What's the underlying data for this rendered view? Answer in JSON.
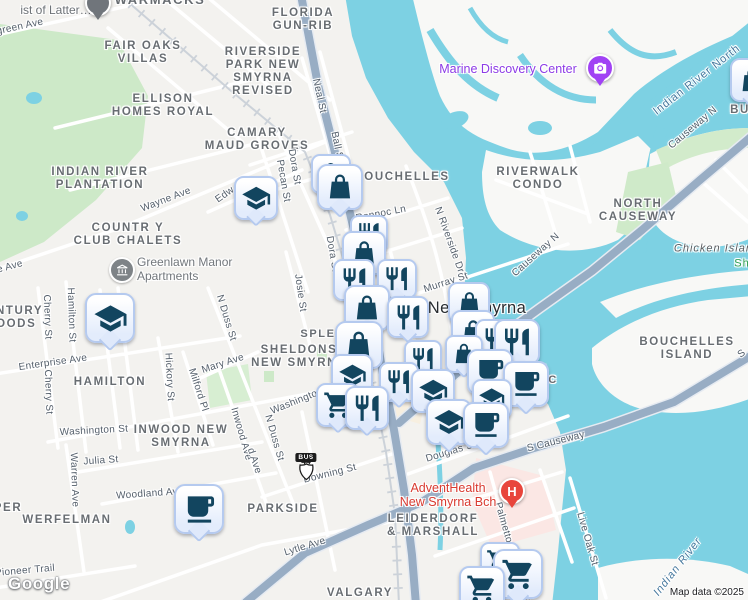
{
  "attribution": {
    "logo": "Google",
    "map_data": "Map data ©2025"
  },
  "shield": {
    "banner": "BUS",
    "route": "44"
  },
  "colors": {
    "water": "#7dd1e3",
    "park": "#cde9c8",
    "major_road": "#98adc4",
    "marker_border": "#b5caef",
    "marker_glyph": "#12455f",
    "hospital_red": "#e8453c",
    "poi_purple": "#8d3be6",
    "adventhealth_red": "#d93a30",
    "water_label": "#47799e"
  },
  "area_labels": [
    {
      "lines": [
        "WARMACKS"
      ],
      "x": 160,
      "y": -7,
      "s": 13
    },
    {
      "lines": [
        "FLORIDA",
        "GUN-RIB"
      ],
      "x": 303,
      "y": 7,
      "s": 11.5
    },
    {
      "lines": [
        "FAIR OAKS",
        "VILLAS"
      ],
      "x": 143,
      "y": 40,
      "s": 11.5
    },
    {
      "lines": [
        "RIVERSIDE",
        "PARK NEW",
        "SMYRNA",
        "REVISED"
      ],
      "x": 263,
      "y": 46,
      "s": 11.5
    },
    {
      "lines": [
        "ELLISON",
        "HOMES ROYAL"
      ],
      "x": 163,
      "y": 93,
      "s": 11.5
    },
    {
      "lines": [
        "CAMARY",
        "MAUD GROVES"
      ],
      "x": 257,
      "y": 127,
      "s": 11.5
    },
    {
      "lines": [
        "INDIAN RIVER",
        "PLANTATION"
      ],
      "x": 100,
      "y": 166,
      "s": 11.5
    },
    {
      "lines": [
        "COUNTR Y",
        "CLUB CHALETS"
      ],
      "x": 128,
      "y": 222,
      "s": 11.5
    },
    {
      "lines": [
        "BOUCHELLES"
      ],
      "x": 402,
      "y": 171,
      "s": 11.5
    },
    {
      "lines": [
        "RIVERWALK",
        "CONDO"
      ],
      "x": 538,
      "y": 166,
      "s": 11.5
    },
    {
      "lines": [
        "NORTH",
        "CAUSEWAY"
      ],
      "x": 638,
      "y": 198,
      "s": 11.5
    },
    {
      "lines": [
        "CENTURY",
        "WOODS"
      ],
      "x": 10,
      "y": 305,
      "s": 11.5
    },
    {
      "lines": [
        "HAMILTON"
      ],
      "x": 110,
      "y": 376,
      "s": 11.5
    },
    {
      "lines": [
        "SPLE"
      ],
      "x": 318,
      "y": 328,
      "s": 11
    },
    {
      "lines": [
        "SHELDONS",
        "NEW SMYRNA"
      ],
      "x": 299,
      "y": 344,
      "s": 11.5
    },
    {
      "lines": [
        "INWOOD NEW",
        "SMYRNA"
      ],
      "x": 181,
      "y": 424,
      "s": 11.5
    },
    {
      "lines": [
        "WERFELMAN"
      ],
      "x": 67,
      "y": 514,
      "s": 11.5
    },
    {
      "lines": [
        "PER"
      ],
      "x": 8,
      "y": 502,
      "s": 11.5
    },
    {
      "lines": [
        "PARKSIDE"
      ],
      "x": 283,
      "y": 503,
      "s": 11.5
    },
    {
      "lines": [
        "LEIDERDORF",
        "& MARSHALL"
      ],
      "x": 433,
      "y": 513,
      "s": 11.5
    },
    {
      "lines": [
        "VALGARY"
      ],
      "x": 360,
      "y": 587,
      "s": 11.5
    },
    {
      "lines": [
        "BOUCHELLES",
        "ISLAND"
      ],
      "x": 687,
      "y": 336,
      "s": 11.5
    },
    {
      "lines": [
        "BU"
      ],
      "x": 740,
      "y": 104,
      "s": 11.5
    },
    {
      "lines": [
        "A"
      ],
      "x": 545,
      "y": 363,
      "s": 11
    },
    {
      "lines": [
        "RIC"
      ],
      "x": 546,
      "y": 374,
      "s": 11
    },
    {
      "lines": [
        "New Smyrna"
      ],
      "x": 477,
      "y": 299,
      "s": 16.5,
      "ls": 0.4,
      "c": "#272b2f",
      "w": 500
    }
  ],
  "street_labels": [
    {
      "t": "green Ave",
      "x": 20,
      "y": 27,
      "r": -12
    },
    {
      "t": "Wayne Ave",
      "x": 166,
      "y": 200,
      "r": -21
    },
    {
      "t": "e Ave",
      "x": 10,
      "y": 267,
      "r": -15
    },
    {
      "t": "Edw",
      "x": 225,
      "y": 195,
      "r": -35
    },
    {
      "t": "Neal St",
      "x": 319,
      "y": 96,
      "r": 78
    },
    {
      "t": "Ball St",
      "x": 337,
      "y": 147,
      "r": 78
    },
    {
      "t": "Dora St",
      "x": 294,
      "y": 167,
      "r": 80
    },
    {
      "t": "Dora St",
      "x": 332,
      "y": 254,
      "r": 80
    },
    {
      "t": "Pecan St",
      "x": 283,
      "y": 181,
      "r": 80
    },
    {
      "t": "Josie St",
      "x": 300,
      "y": 293,
      "r": 82
    },
    {
      "t": "Ronnoc Ln",
      "x": 381,
      "y": 214,
      "r": -11
    },
    {
      "t": "N Riverside Dr",
      "x": 449,
      "y": 240,
      "r": 70
    },
    {
      "t": "Murray St",
      "x": 446,
      "y": 283,
      "r": -18
    },
    {
      "t": "Causeway N",
      "x": 693,
      "y": 128,
      "r": -40
    },
    {
      "t": "Causeway N",
      "x": 536,
      "y": 255,
      "r": -42
    },
    {
      "t": "Cherry St",
      "x": 47,
      "y": 317,
      "r": 88
    },
    {
      "t": "Cherry St",
      "x": 48,
      "y": 392,
      "r": 88
    },
    {
      "t": "Hamilton St",
      "x": 71,
      "y": 315,
      "r": 88
    },
    {
      "t": "Hickory St",
      "x": 169,
      "y": 377,
      "r": 87
    },
    {
      "t": "Milford Pl",
      "x": 198,
      "y": 390,
      "r": 72
    },
    {
      "t": "Mary Ave",
      "x": 223,
      "y": 364,
      "r": -18
    },
    {
      "t": "N Duss St",
      "x": 226,
      "y": 318,
      "r": 73
    },
    {
      "t": "N Duss St",
      "x": 274,
      "y": 438,
      "r": 74
    },
    {
      "t": "Inwood Ave",
      "x": 241,
      "y": 434,
      "r": 74
    },
    {
      "t": "d Ave",
      "x": 254,
      "y": 461,
      "r": 72
    },
    {
      "t": "Enterprise Ave",
      "x": 53,
      "y": 363,
      "r": -8
    },
    {
      "t": "Washington St",
      "x": 94,
      "y": 431,
      "r": -3
    },
    {
      "t": "Washington St",
      "x": 303,
      "y": 399,
      "r": -22
    },
    {
      "t": "Julia St",
      "x": 101,
      "y": 461,
      "r": -4
    },
    {
      "t": "Warren Ave",
      "x": 74,
      "y": 480,
      "r": 88
    },
    {
      "t": "Woodland Ave",
      "x": 150,
      "y": 494,
      "r": -4
    },
    {
      "t": "Pioneer Trail",
      "x": 25,
      "y": 571,
      "r": -5
    },
    {
      "t": "Downing St",
      "x": 330,
      "y": 474,
      "r": -14
    },
    {
      "t": "Douglas St",
      "x": 451,
      "y": 452,
      "r": -17
    },
    {
      "t": "Lytle Ave",
      "x": 305,
      "y": 547,
      "r": -17
    },
    {
      "t": "S Causeway",
      "x": 556,
      "y": 442,
      "r": -14
    },
    {
      "t": "S",
      "x": 742,
      "y": 354,
      "r": -38
    },
    {
      "t": "Live Oak St",
      "x": 587,
      "y": 539,
      "r": 74
    },
    {
      "t": "Palmetto St",
      "x": 505,
      "y": 529,
      "r": 74
    },
    {
      "t": "y St",
      "x": 524,
      "y": 592,
      "r": 72
    }
  ],
  "water_labels": [
    {
      "t": "Indian River North",
      "x": 697,
      "y": 80,
      "r": -38
    },
    {
      "t": "Indian River",
      "x": 678,
      "y": 567,
      "r": -52,
      "i": true
    },
    {
      "t": "Chicken Island",
      "x": 717,
      "y": 249,
      "r": 0,
      "i": true,
      "c": "#5b5e61"
    },
    {
      "t": "Sh",
      "x": 742,
      "y": 264,
      "r": 0,
      "c": "#2e9e4f"
    }
  ],
  "poi_labels": [
    {
      "lines": [
        "ist of Latter…"
      ],
      "x": 56,
      "y": 4,
      "c": "#6d7277",
      "s": 12
    },
    {
      "lines": [
        "Marine Discovery Center"
      ],
      "x": 508,
      "y": 62,
      "c": "#8d3be6",
      "s": 12.5
    },
    {
      "lines": [
        "Greenlawn Manor",
        "Apartments"
      ],
      "x": 137,
      "y": 256,
      "c": "#72777c",
      "s": 12,
      "align": "left",
      "icon": "building"
    },
    {
      "lines": [
        "AdventHealth",
        "New Smyrna Bch"
      ],
      "x": 448,
      "y": 481,
      "c": "#d93a30",
      "s": 12.5
    }
  ],
  "markers": [
    {
      "t": "bag",
      "x": 750,
      "y": 78,
      "s": 40
    },
    {
      "t": "bag",
      "x": 329,
      "y": 172,
      "s": 36
    },
    {
      "t": "bag",
      "x": 338,
      "y": 185,
      "s": 42
    },
    {
      "t": "school",
      "x": 254,
      "y": 196,
      "s": 40
    },
    {
      "t": "rest",
      "x": 367,
      "y": 232,
      "s": 34
    },
    {
      "t": "bag",
      "x": 362,
      "y": 251,
      "s": 40
    },
    {
      "t": "rest",
      "x": 352,
      "y": 278,
      "s": 38
    },
    {
      "t": "rest",
      "x": 395,
      "y": 277,
      "s": 36
    },
    {
      "t": "bag",
      "x": 467,
      "y": 301,
      "s": 38
    },
    {
      "t": "bag",
      "x": 365,
      "y": 306,
      "s": 42
    },
    {
      "t": "rest",
      "x": 406,
      "y": 315,
      "s": 38
    },
    {
      "t": "school",
      "x": 108,
      "y": 316,
      "s": 46
    },
    {
      "t": "bag",
      "x": 471,
      "y": 330,
      "s": 40
    },
    {
      "t": "rest",
      "x": 494,
      "y": 338,
      "s": 38
    },
    {
      "t": "rest",
      "x": 515,
      "y": 340,
      "s": 42
    },
    {
      "t": "bag",
      "x": 357,
      "y": 343,
      "s": 44
    },
    {
      "t": "bag",
      "x": 462,
      "y": 352,
      "s": 34
    },
    {
      "t": "rest",
      "x": 421,
      "y": 357,
      "s": 34
    },
    {
      "t": "cafe",
      "x": 488,
      "y": 370,
      "s": 42
    },
    {
      "t": "school",
      "x": 350,
      "y": 373,
      "s": 38
    },
    {
      "t": "rest",
      "x": 397,
      "y": 380,
      "s": 36
    },
    {
      "t": "cafe",
      "x": 524,
      "y": 382,
      "s": 42
    },
    {
      "t": "school",
      "x": 431,
      "y": 389,
      "s": 40
    },
    {
      "t": "school",
      "x": 490,
      "y": 397,
      "s": 36
    },
    {
      "t": "cart",
      "x": 336,
      "y": 403,
      "s": 40
    },
    {
      "t": "rest",
      "x": 365,
      "y": 406,
      "s": 40
    },
    {
      "t": "school",
      "x": 447,
      "y": 420,
      "s": 42
    },
    {
      "t": "cafe",
      "x": 484,
      "y": 423,
      "s": 42
    },
    {
      "t": "cafe",
      "x": 197,
      "y": 507,
      "s": 46
    },
    {
      "t": "cart",
      "x": 498,
      "y": 560,
      "s": 36
    },
    {
      "t": "cart",
      "x": 516,
      "y": 572,
      "s": 46
    },
    {
      "t": "cart",
      "x": 480,
      "y": 587,
      "s": 42
    }
  ],
  "pins": [
    {
      "type": "camera",
      "x": 598,
      "y": 66,
      "r": 12,
      "color": "#a142f4"
    },
    {
      "type": "hospital",
      "x": 510,
      "y": 489,
      "r": 11,
      "color": "#e8453c",
      "label": "H"
    },
    {
      "type": "generic",
      "x": 96,
      "y": 1,
      "r": 11,
      "color": "#70757b"
    }
  ]
}
